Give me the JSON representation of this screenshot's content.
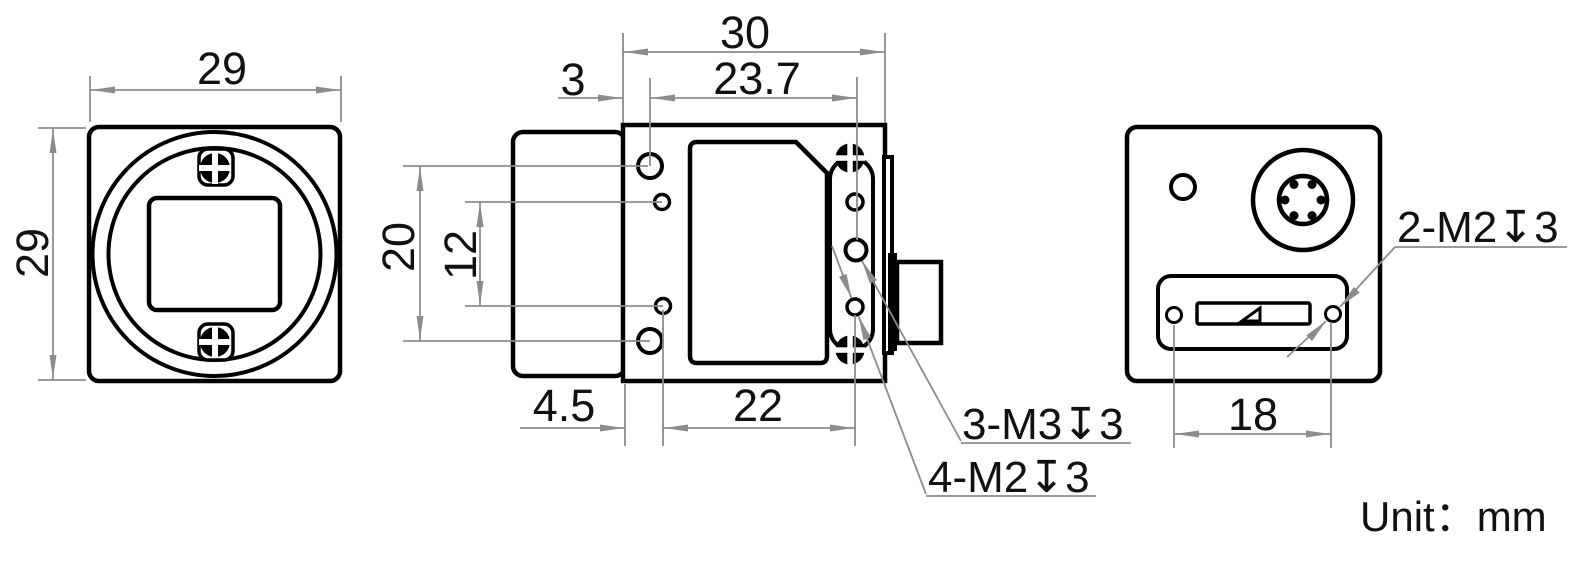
{
  "note": "Unit：mm",
  "colors": {
    "line": "#000000",
    "dimension": "#8c8c8c",
    "text": "#111111",
    "background": "#ffffff"
  },
  "dims": {
    "front_width": "29",
    "front_height": "29",
    "side_width": "30",
    "lens_offset": "3",
    "hole_span_top": "23.7",
    "hole_pitch_outer": "20",
    "hole_pitch_inner": "12",
    "bottom_offset": "4.5",
    "bottom_span": "22",
    "back_screw_span": "18"
  },
  "labels": {
    "side_m3": "3-M3↧3",
    "side_m2": "4-M2↧3",
    "back_m2": "2-M2↧3"
  }
}
